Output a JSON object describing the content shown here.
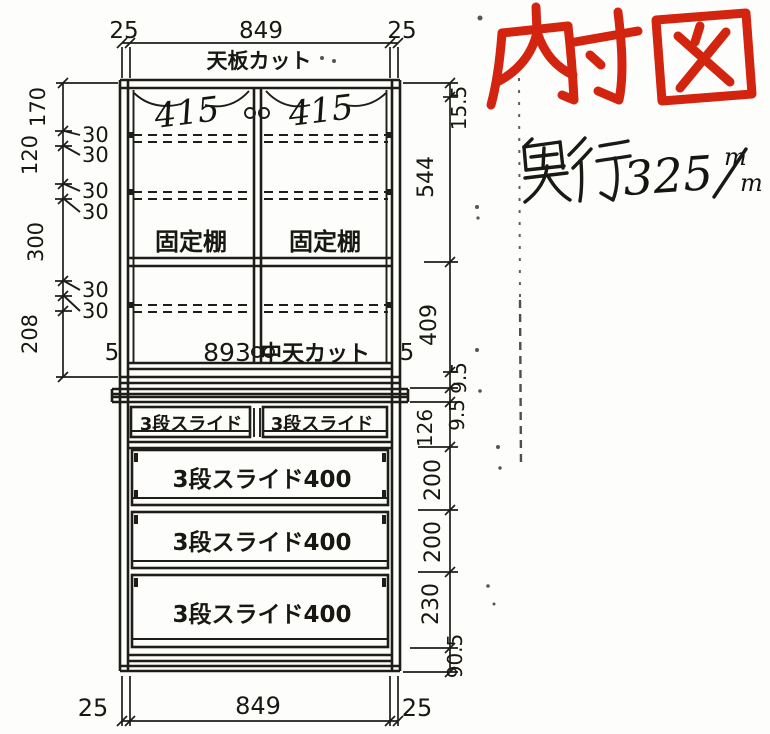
{
  "diagram": {
    "annotations": {
      "title": {
        "text": "内寸図",
        "color": "#d2240f"
      },
      "depth_note": {
        "label": "奥行",
        "value": "325",
        "unit_numerator": "m",
        "unit_denominator": "m",
        "full_text": "奥行325m/m"
      }
    },
    "top_dimension": {
      "left_thickness": "25",
      "inner_width": "849",
      "right_thickness": "25"
    },
    "top_cut_label": "天板カット",
    "upper_unit": {
      "door_left_width": "415",
      "door_right_width": "415",
      "fixed_shelf_left": "固定棚",
      "fixed_shelf_right": "固定棚",
      "mid_board_width": "893",
      "mid_board_label": "中天カット",
      "left_gap": "5",
      "right_gap": "5"
    },
    "left_dimensions": {
      "segments": [
        "170",
        "120",
        "300",
        "208"
      ],
      "shelf_pitch": [
        "30",
        "30",
        "30",
        "30",
        "30",
        "30"
      ]
    },
    "right_dimensions": {
      "segments": [
        "15.5",
        "544",
        "409",
        "9.5",
        "9.5",
        "126",
        "200",
        "200",
        "230",
        "90.5"
      ]
    },
    "lower_unit": {
      "small_drawer_left": "3段スライド",
      "small_drawer_right": "3段スライド",
      "drawers": [
        "3段スライド400",
        "3段スライド400",
        "3段スライド400"
      ]
    },
    "bottom_dimension": {
      "left_thickness": "25",
      "inner_width": "849",
      "right_thickness": "25"
    }
  }
}
